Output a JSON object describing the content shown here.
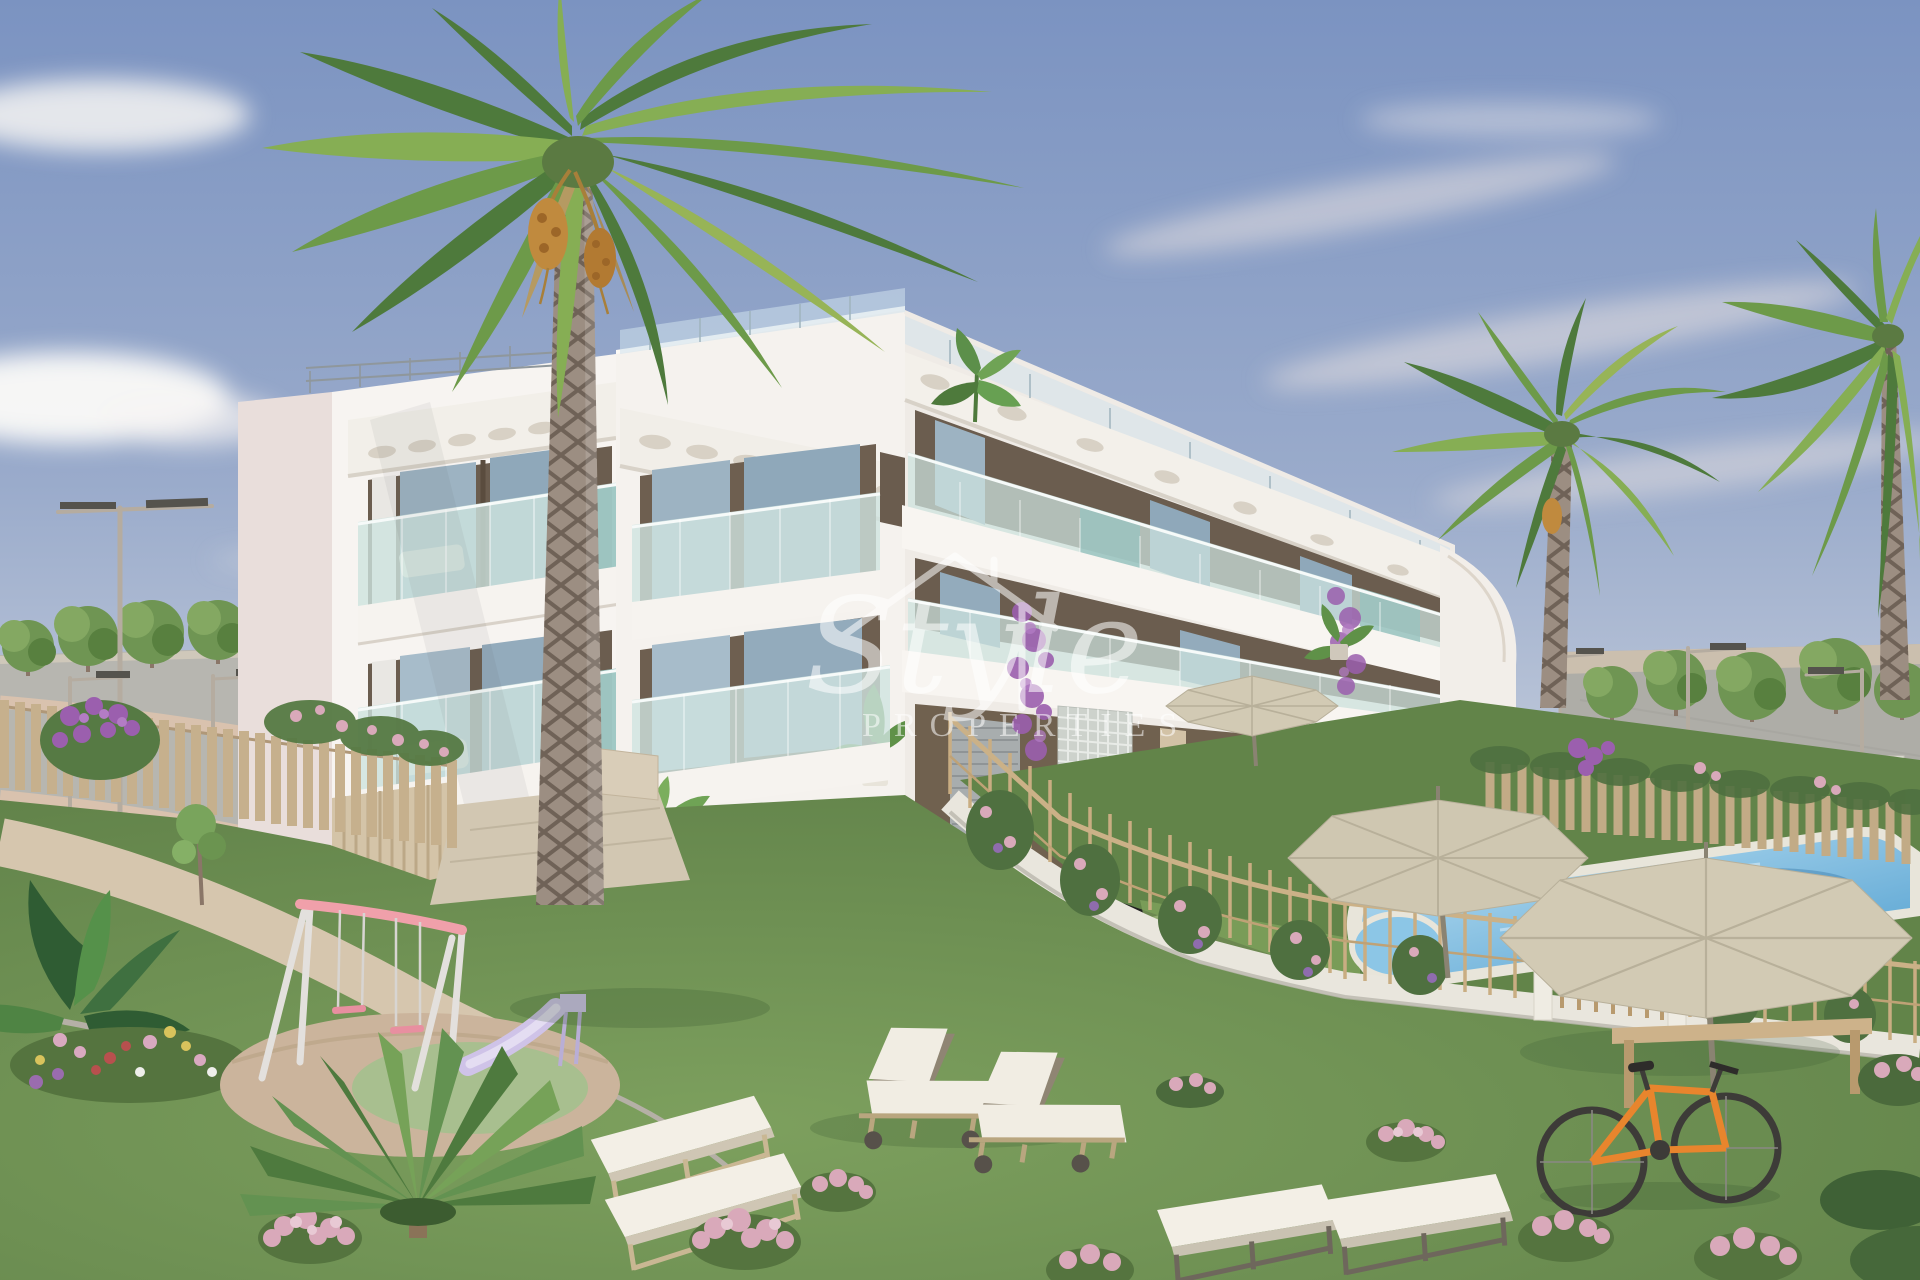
{
  "watermark": {
    "script_text": "Style",
    "caps_text": "PROPERTIES",
    "icon": "house-outline-icon",
    "color": "#ffffff",
    "opacity": "0.55"
  },
  "palette": {
    "sky_top": "#7b93c1",
    "sky_mid": "#9aabcb",
    "sky_horizon": "#ccd3df",
    "cloud_white": "#f6f4f2",
    "building_white": "#f7f4f1",
    "building_shadow_wall": "#e9dedb",
    "opening_dark": "#6b5d4f",
    "glass_teal": "#cde3df",
    "glass_teal_deep": "#98c3bf",
    "rooftop_glass": "#cfe2ec",
    "lawn_light": "#7da05e",
    "lawn_dark": "#5f8048",
    "pool_shallow": "#bfe2f4",
    "pool_deep": "#4f9ecf",
    "pavement_gray": "#b7b6b0",
    "path_beige": "#d6c6ae",
    "picket_wood": "#c6b08d",
    "fence_wood": "#c9ad82",
    "stone_white": "#e9e6dd",
    "parasol_beige": "#d2cab4",
    "lounger_cushion": "#f1ede3",
    "lounger_wood": "#c9b793",
    "swing_pink": "#f0a0aa",
    "slide_lavender": "#cfc3e8",
    "flower_pink": "#d9a9ba",
    "bougainvillea_purple": "#9b5fae",
    "palm_green": "#6d9a49",
    "palm_green_dark": "#4e7a3c",
    "palm_trunk": "#9c8e82",
    "tree_green": "#6f9553",
    "hedge_green": "#47663a",
    "shutter_gray": "#a8adae",
    "bike_orange": "#e8852d"
  },
  "scene": {
    "type": "3d-architectural-render",
    "subject": "modern-white-apartment-complex-with-garden-pool-and-playground",
    "counts": {
      "building_floors": 3,
      "palm_trees": 3,
      "parasols": 3,
      "sun_loungers": 8,
      "street_lamps": 5,
      "swing_sets": 1,
      "slides": 1,
      "bicycles": 1,
      "swimming_pools": 1,
      "kids_pools": 1
    }
  }
}
